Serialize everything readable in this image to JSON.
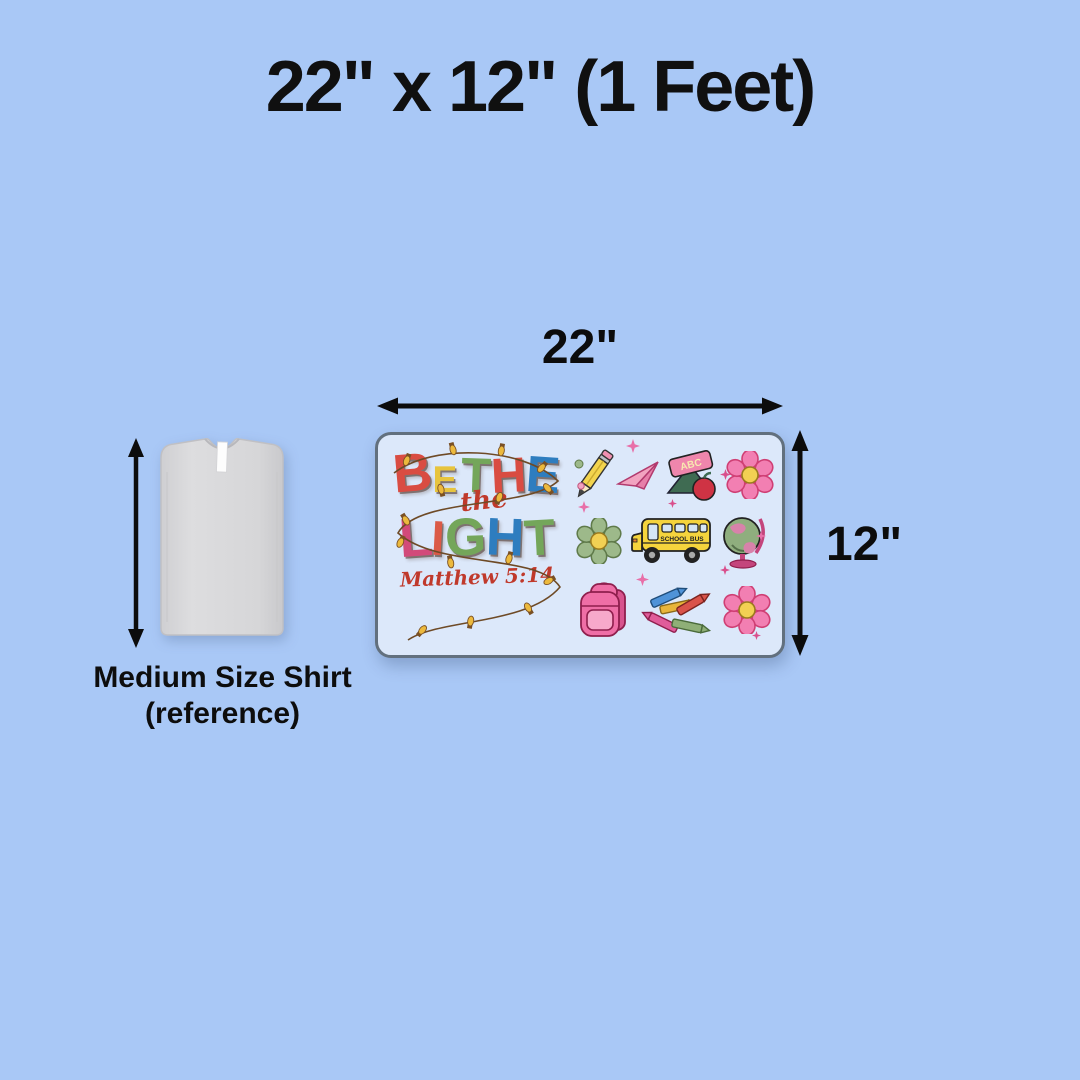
{
  "title": "22\" x 12\" (1 Feet)",
  "dimension": {
    "width_label": "22\"",
    "height_label": "12\""
  },
  "reference": {
    "line1": "Medium Size Shirt",
    "line2": "(reference)"
  },
  "design": {
    "word1": [
      {
        "ch": "B",
        "color": "#d94c42"
      },
      {
        "ch": "E",
        "color": "#e7c43d"
      },
      {
        "ch": "T",
        "color": "#74a65a"
      },
      {
        "ch": "H",
        "color": "#d94c42"
      },
      {
        "ch": "E",
        "color": "#2e7dbf"
      }
    ],
    "word2": "the",
    "word3": [
      {
        "ch": "L",
        "color": "#d24a7a"
      },
      {
        "ch": "I",
        "color": "#db5a47"
      },
      {
        "ch": "G",
        "color": "#74a65a"
      },
      {
        "ch": "H",
        "color": "#2e7dbf"
      },
      {
        "ch": "T",
        "color": "#74a65a"
      }
    ],
    "verse": "Matthew 5:14",
    "script_color": "#c0392b",
    "bus_label": "SCHOOL BUS",
    "book_label": "ABC",
    "icons": [
      "pencil",
      "paper-plane",
      "abc-book-with-apple",
      "pink-flower",
      "green-flower",
      "school-bus",
      "globe",
      "pink-backpack",
      "crayons",
      "pink-flower",
      "sparkles",
      "string-lights"
    ]
  },
  "colors": {
    "background": "#a9c8f6",
    "panel_fill": "#dce8fa",
    "panel_border": "#62707e",
    "arrow": "#0c0c0c",
    "title_text": "#101010",
    "shirt_gray": "#d8d8da"
  }
}
